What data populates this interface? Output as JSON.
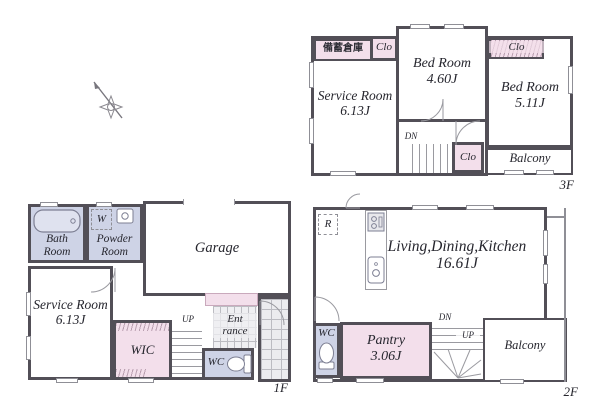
{
  "floor3": {
    "label": "3F",
    "storage": "備蓄倉庫",
    "clo_left": "Clo",
    "clo_right": "Clo",
    "clo_stairs": "Clo",
    "bed_a": {
      "name": "Bed Room",
      "size": "4.60J"
    },
    "bed_b": {
      "name": "Bed Room",
      "size": "5.11J"
    },
    "service": {
      "name": "Service Room",
      "size": "6.13J"
    },
    "balcony": "Balcony",
    "dn": "DN"
  },
  "floor1": {
    "label": "1F",
    "bath_line1": "Bath",
    "bath_line2": "Room",
    "washer": "W",
    "powder_line1": "Powder",
    "powder_line2": "Room",
    "garage": "Garage",
    "service": {
      "name": "Service Room",
      "size": "6.13J"
    },
    "wic": "WIC",
    "up": "UP",
    "wc": "WC",
    "ent_line1": "Ent",
    "ent_line2": "rance"
  },
  "floor2": {
    "label": "2F",
    "fridge": "R",
    "ldk": {
      "name": "Living,Dining,Kitchen",
      "size": "16.61J"
    },
    "wc": "WC",
    "pantry": {
      "name": "Pantry",
      "size": "3.06J"
    },
    "dn": "DN",
    "up": "UP",
    "balcony": "Balcony"
  },
  "colors": {
    "wall": "#524f57",
    "closet_pink": "#f3dfeb",
    "wet_lavender": "#ced3e6",
    "thin_line": "#9a9aa0",
    "text": "#26262e"
  }
}
